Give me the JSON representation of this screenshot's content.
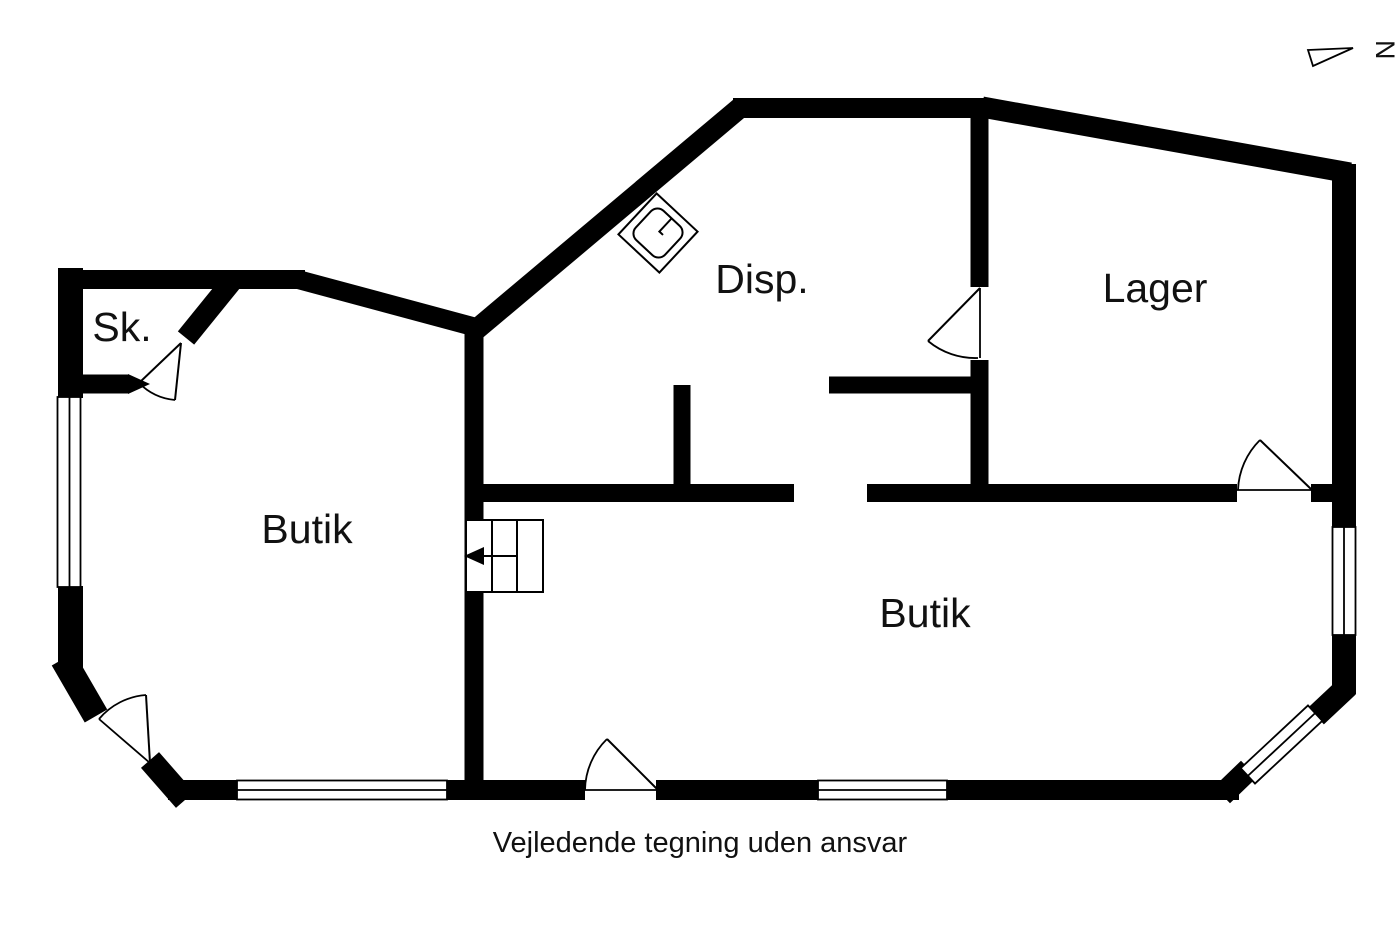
{
  "rooms": {
    "sk": {
      "label": "Sk."
    },
    "butik_left": {
      "label": "Butik"
    },
    "disp": {
      "label": "Disp."
    },
    "lager": {
      "label": "Lager"
    },
    "butik_right": {
      "label": "Butik"
    }
  },
  "compass": {
    "label": "N"
  },
  "caption": {
    "text": "Vejledende tegning uden ansvar"
  },
  "colors": {
    "wall": "#000000",
    "background": "#ffffff",
    "text": "#111111"
  }
}
